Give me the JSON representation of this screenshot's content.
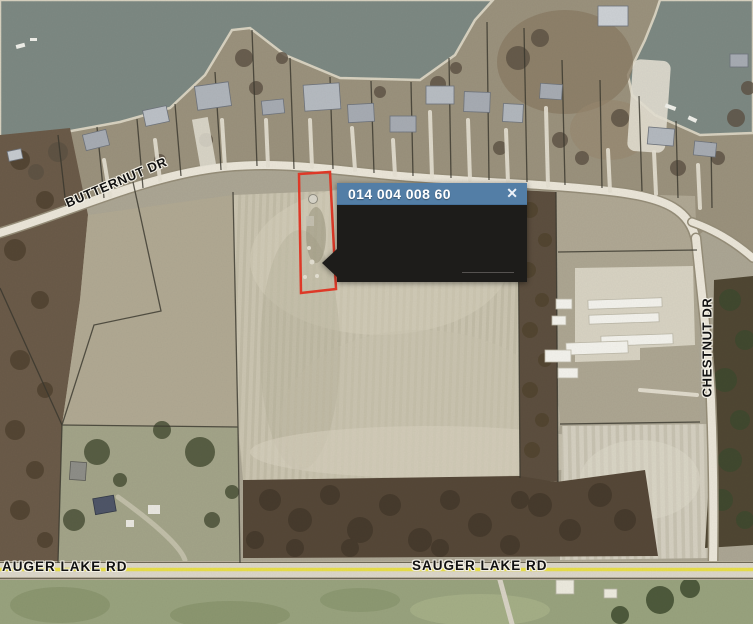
{
  "popup": {
    "title": "014 004 008 60",
    "close_glyph": "✕"
  },
  "roads": {
    "butternut_label": "BUTTERNUT DR",
    "chestnut_label": "CHESTNUT DR",
    "sauger_lake_left_label": "AUGER LAKE RD",
    "sauger_lake_center_label": "SAUGER LAKE RD"
  },
  "selected_parcel": {
    "parcel_id": "014 004 008 60",
    "outline_color": "#e23a28"
  },
  "colors": {
    "water": "#7d8983",
    "residential_band": "#9b927d",
    "field_light": "#cbc5b1",
    "woods": "#564838",
    "road_surface": "#eae5d8",
    "road_centerline_highlight": "#e8df49",
    "popup_header": "#537ea6",
    "popup_body": "#1d1c1a",
    "parcel_line": "#3a382e"
  }
}
